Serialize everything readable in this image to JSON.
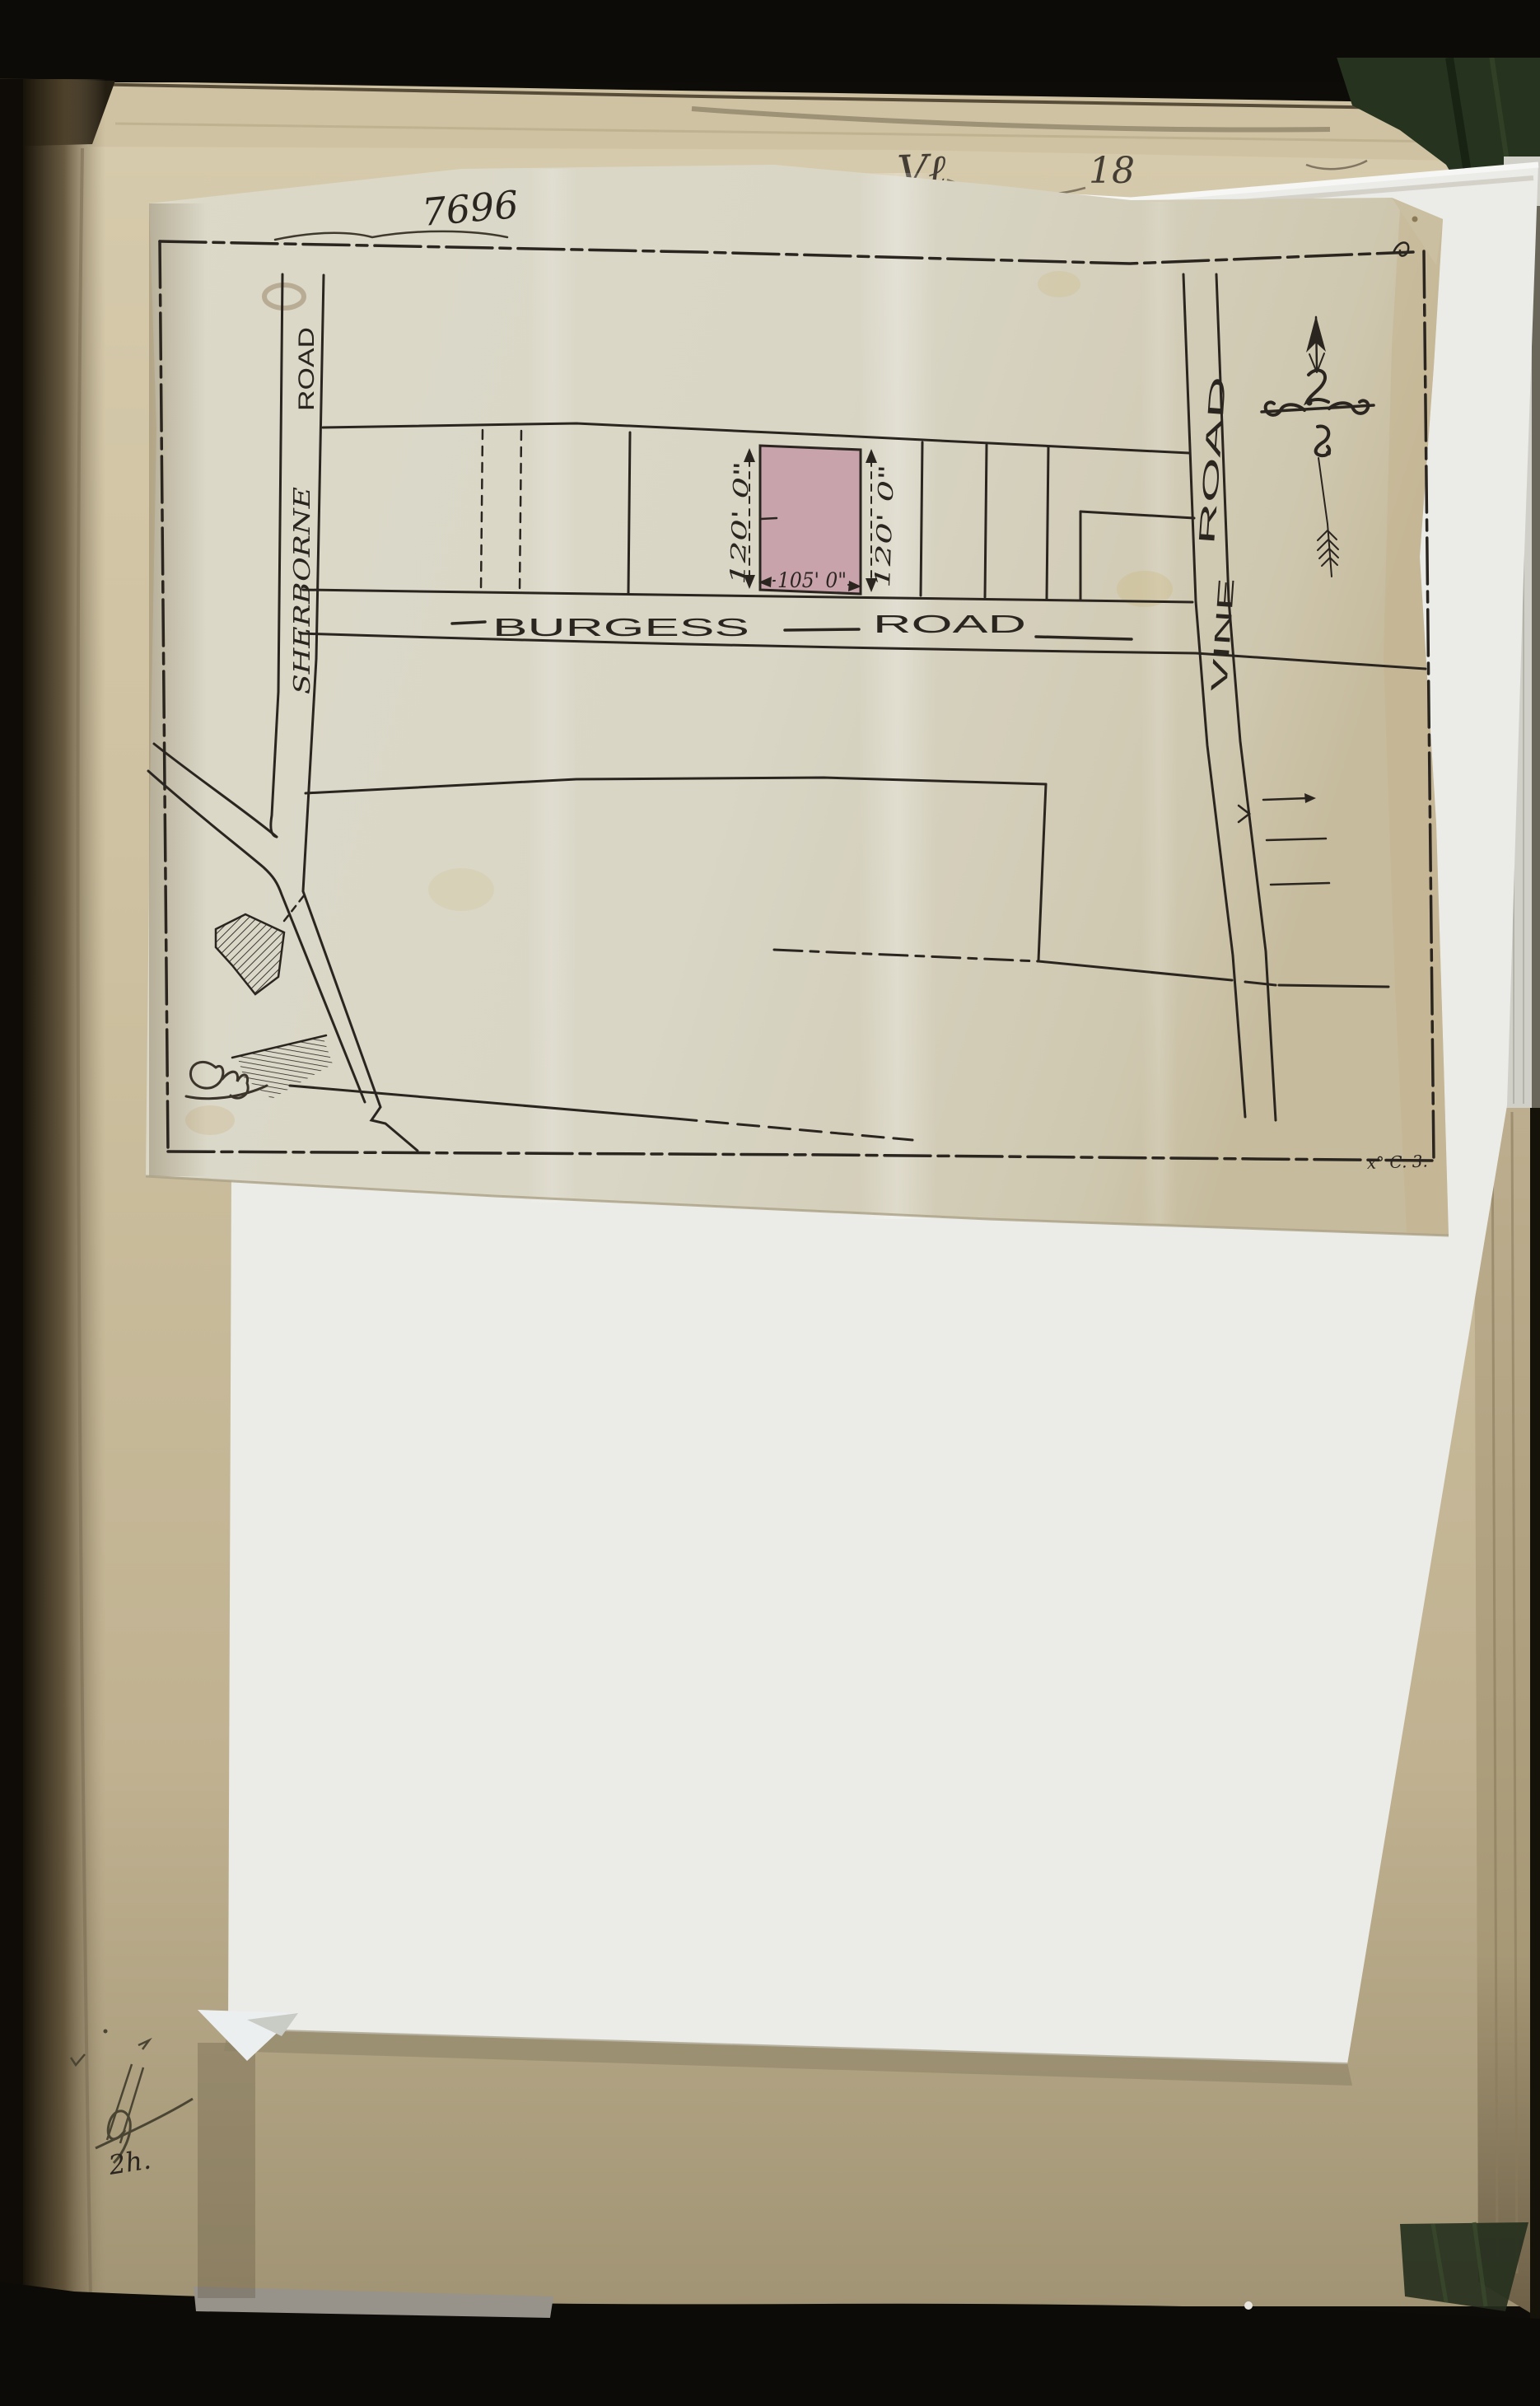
{
  "document_type": "scanned archival street plan pasted into bound volume",
  "plan": {
    "number": "7696",
    "sheet_note": "x° C. 3.",
    "roads": {
      "sherborne": {
        "name": "SHERBORNE ROAD",
        "word1": "SHERBORNE",
        "word2": "ROAD"
      },
      "burgess": {
        "name": "BURGESS ROAD",
        "word1": "BURGESS",
        "word2": "ROAD"
      },
      "vine": {
        "name": "VINE ROAD",
        "word1": "VINE",
        "word2": "ROAD"
      }
    },
    "plot": {
      "fill_color": "#c9a3ab",
      "depth_left": "120' 0\"",
      "depth_right": "120' 0\"",
      "frontage": "105' 0\""
    },
    "compass": {
      "icon": "north-arrow-icon"
    },
    "surveyor_initials_flourish": "P.W. (flourished initials, lower left of plan)"
  },
  "page": {
    "inscription_fragments": {
      "left": "Vℓ",
      "right": "18"
    },
    "pencil_note": "2h.",
    "pencil_monogram": "JH (flourished pencil monogram, bottom left)"
  },
  "colors": {
    "ink": "#2b2520",
    "tracing_paper": "#d9d6c6",
    "white_sheet": "#ebebe7",
    "book_page": "#cdc1a1",
    "plot_pink": "#c9a3ab",
    "cover_green": "#26331e"
  }
}
